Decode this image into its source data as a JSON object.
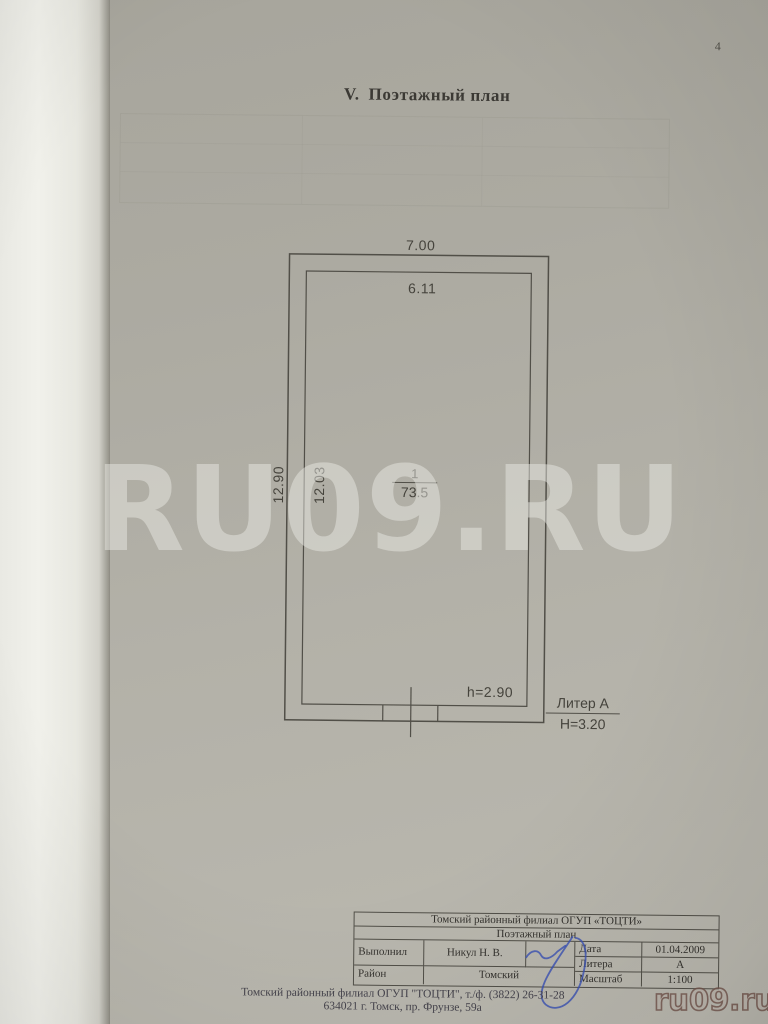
{
  "page": {
    "number": "4",
    "title_numeral": "V.",
    "title_text": "Поэтажный план"
  },
  "plan": {
    "dim_outer_width": "7.00",
    "dim_inner_width": "6.11",
    "dim_outer_height": "12.90",
    "dim_inner_height": "12.03",
    "room_number": "1",
    "room_area": "73.5",
    "ceiling_height": "h=2.90",
    "liter_label": "Литер А",
    "building_height": "H=3.20"
  },
  "stamp_table": {
    "organization": "Томский районный филиал ОГУП «ТОЦТИ»",
    "document_type": "Поэтажный план",
    "executed_label": "Выполнил",
    "executed_by": "Никул Н. В.",
    "district_label": "Район",
    "district_value": "Томский",
    "date_label": "Дата",
    "date_value": "01.04.2009",
    "litera_label": "Литера",
    "litera_value": "А",
    "scale_label": "Масштаб",
    "scale_value": "1:100"
  },
  "footer": {
    "line1": "Томский районный филиал ОГУП \"ТОЦТИ\", т./ф. (3822) 26-31-28",
    "line2": "634021 г. Томск, пр. Фрунзе, 59а"
  },
  "watermarks": {
    "center": "RU09.RU",
    "corner": "ru09.ru"
  },
  "colors": {
    "paper": "#b3b1a8",
    "drawing_line": "#514f48",
    "signature_ink": "#3750b5"
  }
}
